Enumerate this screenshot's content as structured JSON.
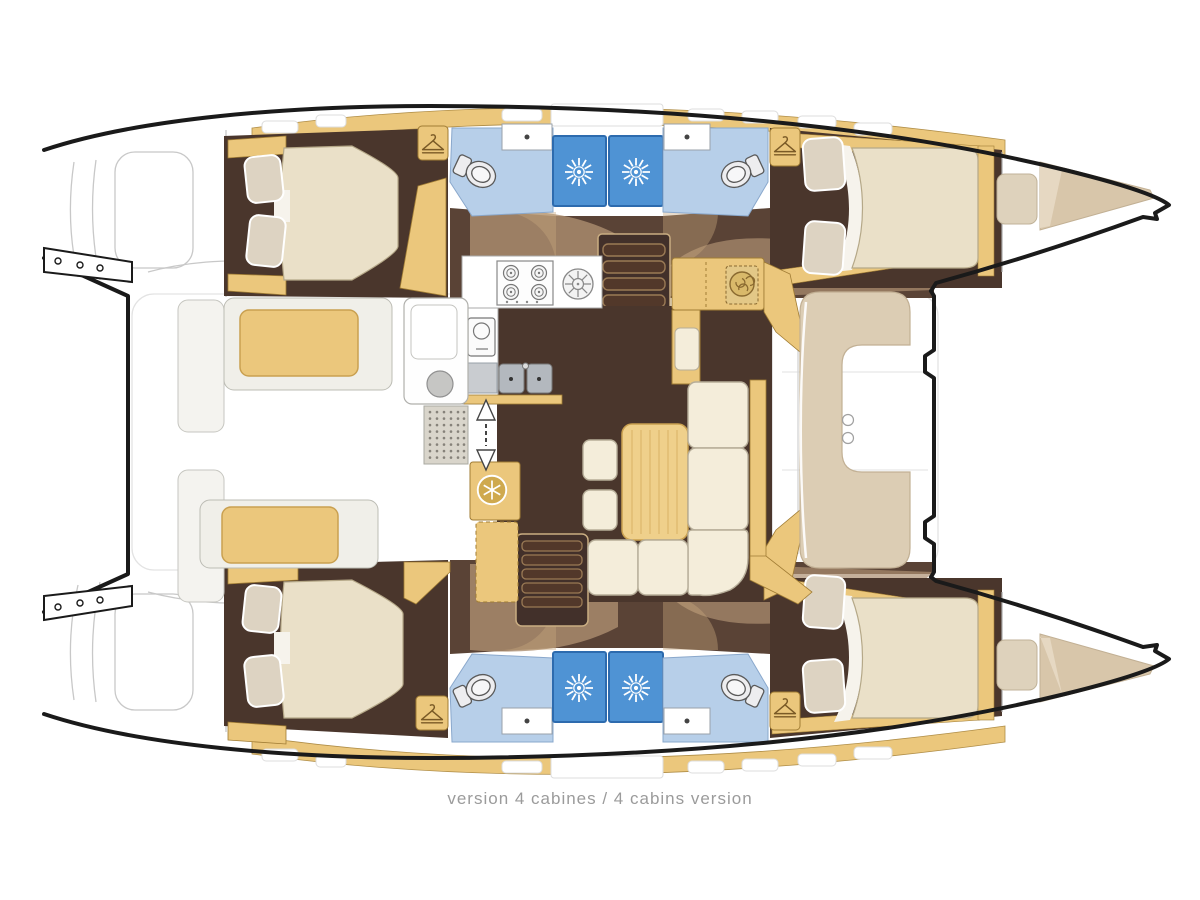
{
  "page": {
    "width": 1200,
    "height": 900,
    "background": "#ffffff"
  },
  "caption": {
    "text": "version 4 cabines / 4 cabins version"
  },
  "plan": {
    "subject": "catamaran yacht interior deck plan, top view",
    "labels": {
      "fr": "version 4 cabines",
      "en": "4 cabins version"
    },
    "cabins": 4,
    "bathrooms": 4,
    "rooms": [
      "port aft cabin",
      "port forward cabin",
      "starboard aft cabin",
      "starboard forward cabin",
      "port aft bathroom",
      "port forward bathroom",
      "starboard aft bathroom",
      "starboard forward bathroom",
      "galley",
      "saloon",
      "nav station",
      "aft cockpit",
      "forward cockpit",
      "bow lockers"
    ],
    "fixtures": [
      "double berth x4",
      "pillows x8",
      "toilet x4",
      "shower stall x4",
      "washbasin x4",
      "4-burner stove",
      "round burner",
      "oven",
      "double sink",
      "fridge-freezer",
      "saloon table",
      "L-shaped sofa",
      "stools x2",
      "chart table",
      "companionway stairs x2",
      "cockpit benches",
      "forward lounge seat",
      "bow cushions"
    ],
    "icon_glyphs": [
      "hanger-icon",
      "shower-sunburst-icon",
      "snowflake-fridge-icon",
      "compass-icon",
      "companionway-arrows-icon",
      "burner-icon"
    ]
  },
  "palette": {
    "hull_outline": "#1a1a1a",
    "sketch_gray": "#c8c8c8",
    "woodwork_tan": "#ebc77c",
    "wood_trim": "#a07c34",
    "cabin_floor_dark": "#4a362c",
    "corridor_brown": "#5a4336",
    "corridor_overlay": "#ad8f70",
    "mattress_cream": "#eae0c8",
    "pillow_beige": "#ddd3c2",
    "bathroom_floor_blue": "#b7cfe9",
    "shower_blue": "#4f93d4",
    "sofa_cream": "#f4edda",
    "table_tan": "#efd08b",
    "cockpit_lounge_beige": "#dccdb4",
    "caption_gray": "#9b9b9b"
  }
}
